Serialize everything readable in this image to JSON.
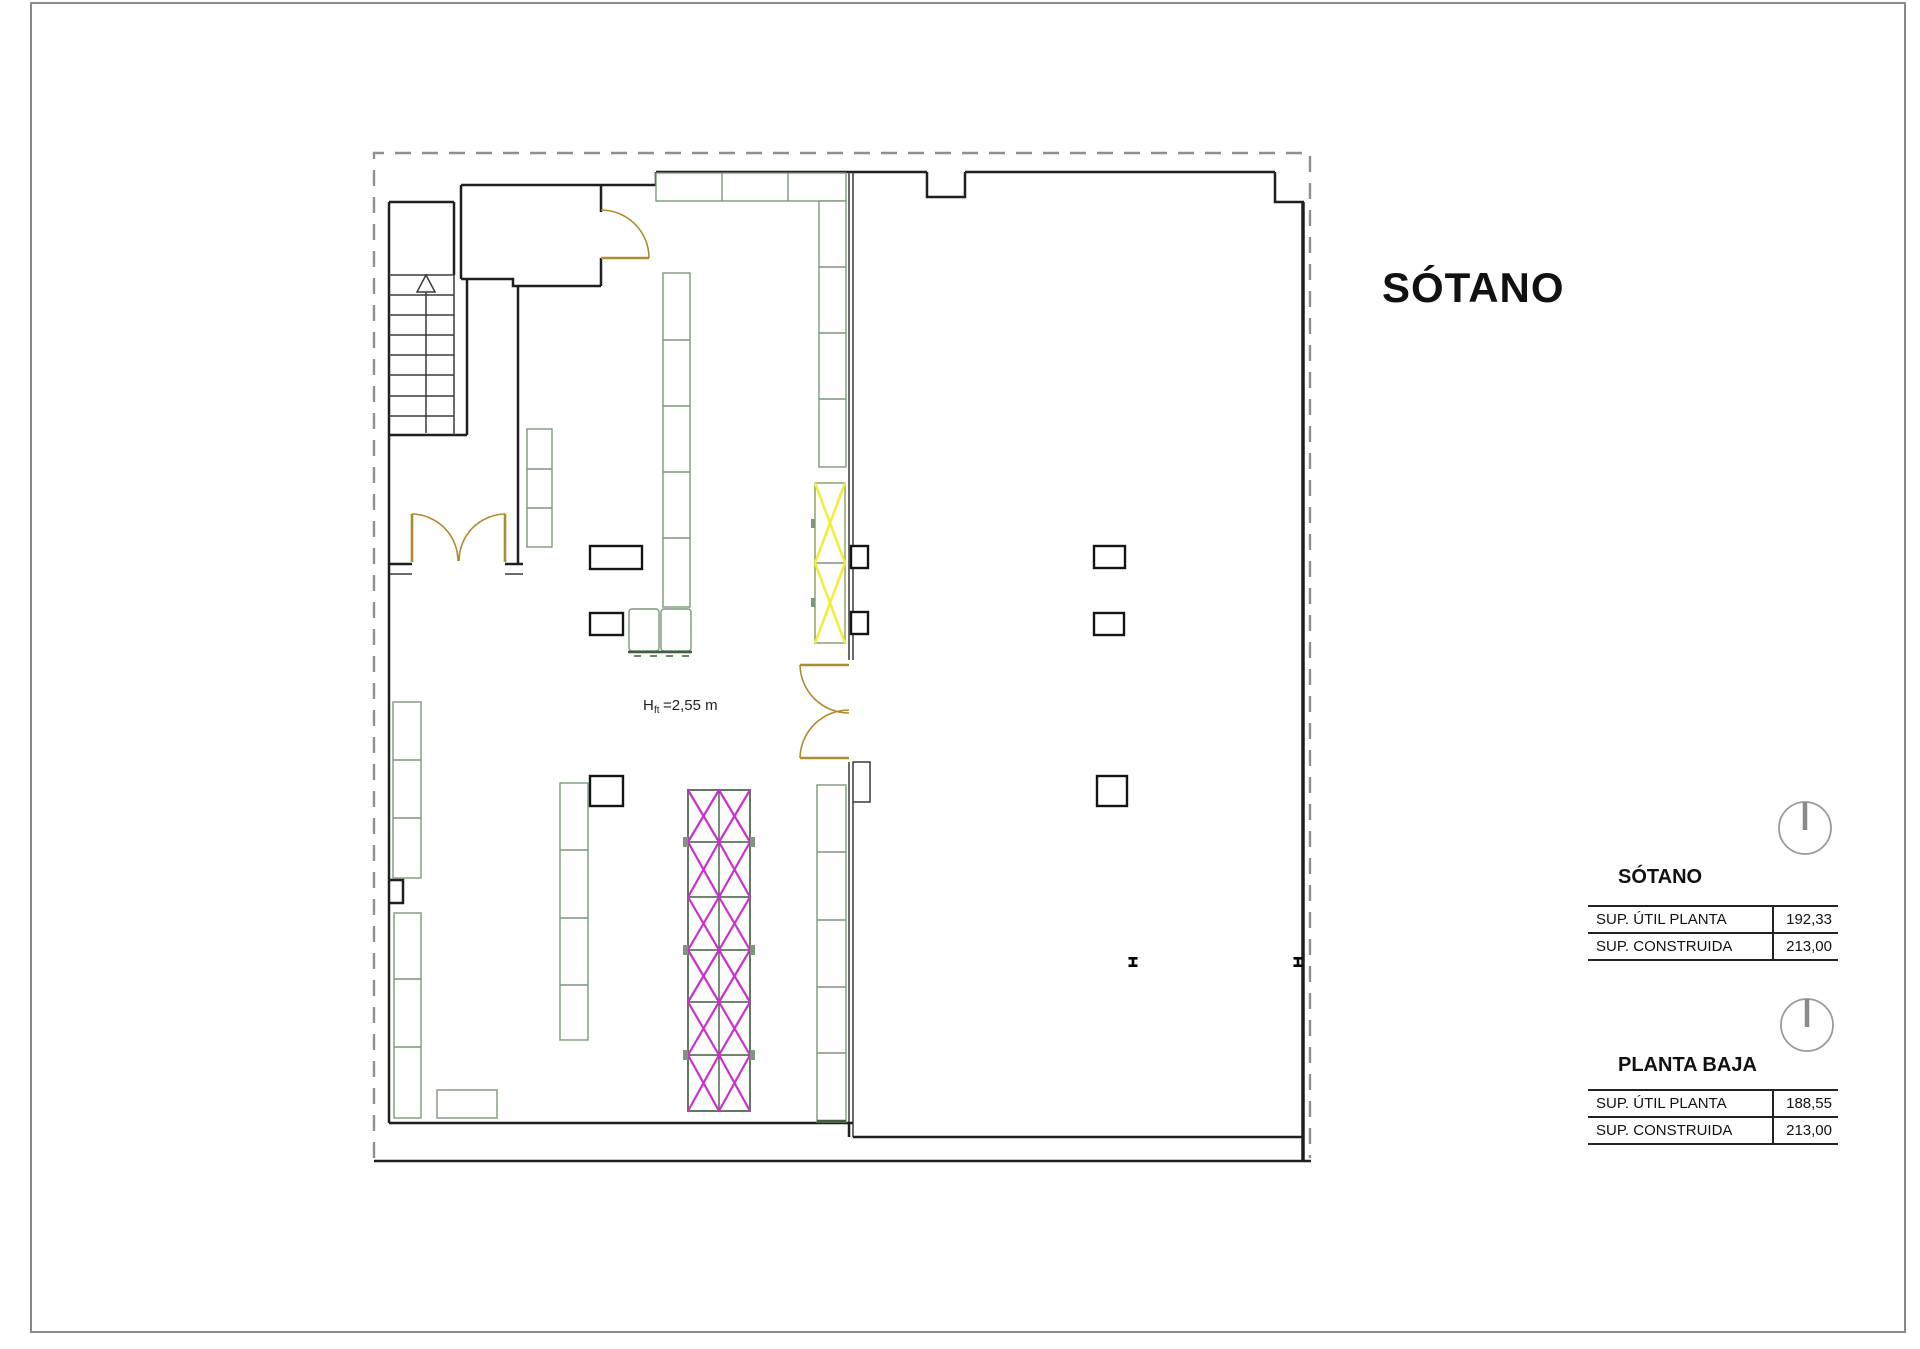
{
  "main_title": "SÓTANO",
  "plan": {
    "clear_height": {
      "prefix": "H",
      "subscript": "ft",
      "value": "=2,55 m"
    }
  },
  "summary_blocks": [
    {
      "title": "SÓTANO",
      "rows": [
        {
          "label": "SUP. ÚTIL PLANTA",
          "value": "192,33"
        },
        {
          "label": "SUP. CONSTRUIDA",
          "value": "213,00"
        }
      ]
    },
    {
      "title": "PLANTA BAJA",
      "rows": [
        {
          "label": "SUP. ÚTIL PLANTA",
          "value": "188,55"
        },
        {
          "label": "SUP. CONSTRUIDA",
          "value": "213,00"
        }
      ]
    }
  ],
  "colors": {
    "wall": "#1f1f1f",
    "boundary_dashed": "#8f8f8f",
    "shelving": "#7d967d",
    "shelving_dark": "#3f5f3f",
    "door": "#ad8c2d",
    "hatch_yellow": "#f0ef35",
    "hatch_magenta": "#ce2ece",
    "sheet_frame": "#8a8a8a",
    "text": "#111111"
  }
}
